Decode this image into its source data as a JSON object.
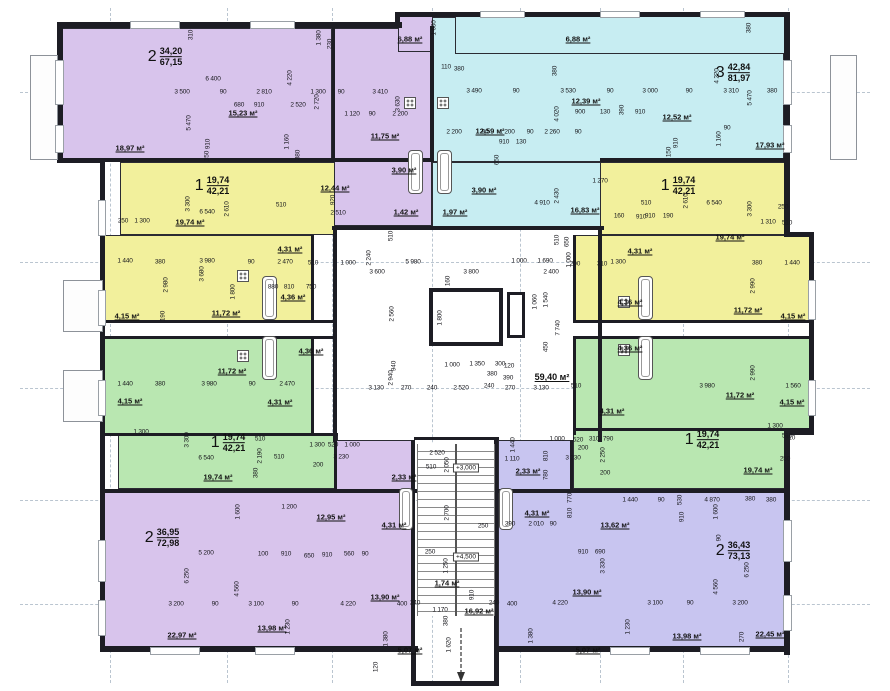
{
  "sheet": {
    "width": 890,
    "height": 691
  },
  "colors": {
    "purple": "#d8c4ec",
    "cyan": "#c7edf2",
    "yellow": "#f2f09c",
    "green": "#b9e7b1",
    "blue": "#c8c5f0",
    "wall": "#1d1d24",
    "text": "#17171c",
    "axis": "#b6c2cc"
  },
  "apartments": [
    {
      "id": "apt-2room-top-left",
      "color": "purple",
      "unit": {
        "num": "2",
        "area_living": "34,20",
        "area_total": "67,15"
      },
      "unit_pos": {
        "x": 165,
        "y": 57
      },
      "regions": [
        [
          57,
          28,
          275,
          132
        ],
        [
          332,
          28,
          100,
          198
        ],
        [
          398,
          12,
          57,
          40
        ]
      ]
    },
    {
      "id": "apt-3room-top-right",
      "color": "cyan",
      "unit": {
        "num": "3",
        "area_living": "42,84",
        "area_total": "81,97"
      },
      "unit_pos": {
        "x": 733,
        "y": 73
      },
      "regions": [
        [
          432,
          17,
          352,
          145
        ],
        [
          432,
          162,
          172,
          66
        ],
        [
          455,
          12,
          333,
          42
        ]
      ]
    },
    {
      "id": "apt-1room-left-upper",
      "color": "yellow",
      "unit": {
        "num": "1",
        "area_living": "19,74",
        "area_total": "42,21"
      },
      "unit_pos": {
        "x": 212,
        "y": 186
      },
      "regions": [
        [
          120,
          162,
          215,
          73
        ],
        [
          103,
          235,
          210,
          87
        ]
      ]
    },
    {
      "id": "apt-1room-right-upper",
      "color": "yellow",
      "unit": {
        "num": "1",
        "area_living": "19,74",
        "area_total": "42,21"
      },
      "unit_pos": {
        "x": 678,
        "y": 186
      },
      "regions": [
        [
          600,
          162,
          188,
          73
        ],
        [
          575,
          235,
          238,
          87
        ]
      ]
    },
    {
      "id": "apt-1room-left-lower",
      "color": "green",
      "unit": {
        "num": "1",
        "area_living": "19,74",
        "area_total": "42,21"
      },
      "unit_pos": {
        "x": 228,
        "y": 443
      },
      "regions": [
        [
          103,
          338,
          210,
          97
        ],
        [
          118,
          435,
          220,
          54
        ]
      ]
    },
    {
      "id": "apt-1room-right-lower",
      "color": "green",
      "unit": {
        "num": "1",
        "area_living": "19,74",
        "area_total": "42,21"
      },
      "unit_pos": {
        "x": 702,
        "y": 440
      },
      "regions": [
        [
          575,
          338,
          238,
          92
        ],
        [
          573,
          430,
          217,
          59
        ]
      ]
    },
    {
      "id": "apt-2room-bottom-left",
      "color": "purple",
      "unit": {
        "num": "2",
        "area_living": "36,95",
        "area_total": "72,98"
      },
      "unit_pos": {
        "x": 162,
        "y": 538
      },
      "regions": [
        [
          100,
          492,
          314,
          156
        ],
        [
          336,
          440,
          78,
          52
        ]
      ]
    },
    {
      "id": "apt-2room-bottom-right",
      "color": "blue",
      "unit": {
        "num": "2",
        "area_living": "36,43",
        "area_total": "73,13"
      },
      "unit_pos": {
        "x": 733,
        "y": 551
      },
      "regions": [
        [
          498,
          492,
          290,
          156
        ],
        [
          498,
          440,
          75,
          52
        ]
      ]
    }
  ],
  "core": {
    "levels": [
      [
        "+3,000",
        466,
        468
      ],
      [
        "+4,500",
        466,
        557
      ]
    ]
  },
  "room_labels": [
    [
      "18,97 м²",
      130,
      148
    ],
    [
      "15,23 м²",
      243,
      113
    ],
    [
      "11,75 м²",
      385,
      136
    ],
    [
      "3,90 м²",
      404,
      170
    ],
    [
      "12,44 м²",
      335,
      188
    ],
    [
      "1,42 м²",
      406,
      212
    ],
    [
      "6,88 м²",
      410,
      39
    ],
    [
      "6,88 м²",
      578,
      39
    ],
    [
      "12,59 м²",
      490,
      131
    ],
    [
      "12,39 м²",
      586,
      101
    ],
    [
      "3,90 м²",
      484,
      190
    ],
    [
      "1,97 м²",
      455,
      212
    ],
    [
      "16,83 м²",
      585,
      210
    ],
    [
      "12,52 м²",
      677,
      117
    ],
    [
      "17,93 м²",
      770,
      145
    ],
    [
      "19,74 м²",
      190,
      222
    ],
    [
      "4,31 м²",
      290,
      249
    ],
    [
      "4,36 м²",
      293,
      297
    ],
    [
      "11,72 м²",
      226,
      313
    ],
    [
      "4,15 м²",
      127,
      316
    ],
    [
      "11,72 м²",
      232,
      371
    ],
    [
      "4,36 м²",
      311,
      351
    ],
    [
      "4,31 м²",
      280,
      402
    ],
    [
      "4,15 м²",
      130,
      401
    ],
    [
      "19,74 м²",
      218,
      477
    ],
    [
      "19,74 м²",
      730,
      237
    ],
    [
      "4,31 м²",
      640,
      251
    ],
    [
      "4,36 м²",
      630,
      302
    ],
    [
      "11,72 м²",
      748,
      310
    ],
    [
      "4,15 м²",
      793,
      316
    ],
    [
      "4,36 м²",
      630,
      348
    ],
    [
      "11,72 м²",
      740,
      395
    ],
    [
      "4,31 м²",
      612,
      411
    ],
    [
      "4,15 м²",
      792,
      402
    ],
    [
      "19,74 м²",
      758,
      470
    ],
    [
      "2,33 м²",
      404,
      477
    ],
    [
      "4,31 м²",
      394,
      525
    ],
    [
      "12,95 м²",
      331,
      517
    ],
    [
      "13,90 м²",
      385,
      597
    ],
    [
      "22,97 м²",
      182,
      635
    ],
    [
      "13,98 м²",
      272,
      628
    ],
    [
      "5,07 м²",
      410,
      650
    ],
    [
      "2,33 м²",
      528,
      471
    ],
    [
      "4,31 м²",
      537,
      513
    ],
    [
      "13,62 м²",
      615,
      525
    ],
    [
      "13,90 м²",
      587,
      592
    ],
    [
      "22,45 м²",
      770,
      634
    ],
    [
      "13,98 м²",
      687,
      636
    ],
    [
      "5,07 м²",
      588,
      650
    ],
    [
      "59,40 м²",
      552,
      377,
      1
    ],
    [
      "1,74 м²",
      447,
      583
    ],
    [
      "16,92 м²",
      479,
      611
    ]
  ],
  "dim_labels": [
    [
      "310",
      191,
      35,
      1
    ],
    [
      "1 380",
      319,
      38,
      1
    ],
    [
      "230",
      330,
      44,
      1
    ],
    [
      "1 630",
      434,
      28,
      1
    ],
    [
      "380",
      749,
      28,
      1
    ],
    [
      "6 400",
      213,
      79
    ],
    [
      "4 220",
      290,
      78,
      1
    ],
    [
      "4 220",
      717,
      76,
      1
    ],
    [
      "3 500",
      182,
      92
    ],
    [
      "90",
      223,
      92
    ],
    [
      "2 810",
      264,
      92
    ],
    [
      "1 300",
      318,
      92
    ],
    [
      "90",
      341,
      92
    ],
    [
      "3 410",
      380,
      92
    ],
    [
      "110",
      446,
      67
    ],
    [
      "380",
      459,
      69
    ],
    [
      "3 490",
      474,
      91
    ],
    [
      "90",
      516,
      91
    ],
    [
      "3 530",
      568,
      91
    ],
    [
      "90",
      610,
      91
    ],
    [
      "3 000",
      650,
      91
    ],
    [
      "90",
      689,
      91
    ],
    [
      "3 310",
      731,
      91
    ],
    [
      "380",
      772,
      91
    ],
    [
      "680",
      239,
      105
    ],
    [
      "910",
      259,
      105
    ],
    [
      "2 520",
      298,
      105
    ],
    [
      "5 470",
      189,
      123,
      1
    ],
    [
      "5 470",
      750,
      98,
      1
    ],
    [
      "380",
      555,
      71,
      1
    ],
    [
      "4 020",
      557,
      114,
      1
    ],
    [
      "900",
      580,
      112
    ],
    [
      "130",
      605,
      112
    ],
    [
      "390",
      622,
      110,
      1
    ],
    [
      "910",
      640,
      112
    ],
    [
      "1 120",
      352,
      114
    ],
    [
      "90",
      372,
      114
    ],
    [
      "2 200",
      400,
      114
    ],
    [
      "2 720",
      317,
      102,
      1
    ],
    [
      "3 630",
      398,
      104,
      1
    ],
    [
      "1 160",
      287,
      142,
      1
    ],
    [
      "380",
      298,
      155,
      1
    ],
    [
      "910",
      208,
      144,
      1
    ],
    [
      "150",
      207,
      156,
      1
    ],
    [
      "1 160",
      719,
      139,
      1
    ],
    [
      "90",
      727,
      128
    ],
    [
      "910",
      676,
      143,
      1
    ],
    [
      "150",
      669,
      152,
      1
    ],
    [
      "2 200",
      454,
      132
    ],
    [
      "90",
      485,
      132
    ],
    [
      "1 200",
      507,
      132
    ],
    [
      "90",
      530,
      132
    ],
    [
      "2 260",
      552,
      132
    ],
    [
      "90",
      578,
      132
    ],
    [
      "910",
      504,
      142
    ],
    [
      "130",
      521,
      142
    ],
    [
      "650",
      497,
      160,
      1
    ],
    [
      "2 430",
      557,
      196,
      1
    ],
    [
      "4 910",
      542,
      203
    ],
    [
      "1 270",
      600,
      181
    ],
    [
      "160",
      619,
      216
    ],
    [
      "910",
      641,
      217
    ],
    [
      "2 510",
      338,
      213
    ],
    [
      "920",
      333,
      200,
      1
    ],
    [
      "250",
      123,
      221
    ],
    [
      "1 300",
      142,
      221
    ],
    [
      "6 540",
      207,
      212
    ],
    [
      "2 610",
      227,
      209,
      1
    ],
    [
      "3 300",
      188,
      204,
      1
    ],
    [
      "510",
      281,
      205
    ],
    [
      "510",
      646,
      203
    ],
    [
      "910",
      650,
      216
    ],
    [
      "190",
      668,
      216
    ],
    [
      "6 540",
      714,
      203
    ],
    [
      "2 610",
      686,
      201,
      1
    ],
    [
      "3 300",
      750,
      209,
      1
    ],
    [
      "1 310",
      768,
      222
    ],
    [
      "510",
      787,
      223
    ],
    [
      "250",
      783,
      207
    ],
    [
      "1 440",
      125,
      261
    ],
    [
      "380",
      160,
      262
    ],
    [
      "3 980",
      207,
      261
    ],
    [
      "90",
      251,
      262
    ],
    [
      "2 470",
      285,
      262
    ],
    [
      "510",
      313,
      263
    ],
    [
      "1 000",
      348,
      263
    ],
    [
      "2 980",
      166,
      285,
      1
    ],
    [
      "3 680",
      202,
      274,
      1
    ],
    [
      "880",
      273,
      287
    ],
    [
      "810",
      289,
      287
    ],
    [
      "750",
      311,
      287
    ],
    [
      "190",
      163,
      316,
      1
    ],
    [
      "1 800",
      233,
      292,
      1
    ],
    [
      "1 440",
      125,
      384
    ],
    [
      "380",
      160,
      384
    ],
    [
      "3 980",
      209,
      384
    ],
    [
      "90",
      252,
      384
    ],
    [
      "2 470",
      287,
      384
    ],
    [
      "1 300",
      141,
      432
    ],
    [
      "1 440",
      792,
      263
    ],
    [
      "380",
      757,
      263
    ],
    [
      "2 990",
      753,
      286,
      1
    ],
    [
      "1 300",
      618,
      262
    ],
    [
      "1 560",
      793,
      386
    ],
    [
      "3 980",
      707,
      386
    ],
    [
      "2 990",
      753,
      373,
      1
    ],
    [
      "1 300",
      775,
      426
    ],
    [
      "510",
      790,
      438
    ],
    [
      "510",
      391,
      236,
      1
    ],
    [
      "2 240",
      369,
      258,
      1
    ],
    [
      "5 980",
      413,
      262
    ],
    [
      "1 000",
      519,
      261
    ],
    [
      "1 690",
      545,
      261
    ],
    [
      "3 600",
      377,
      272
    ],
    [
      "3 800",
      471,
      272
    ],
    [
      "2 400",
      551,
      272
    ],
    [
      "650",
      567,
      242,
      1
    ],
    [
      "510",
      557,
      240,
      1
    ],
    [
      "1 000",
      569,
      260,
      1
    ],
    [
      "200",
      575,
      264
    ],
    [
      "310",
      602,
      264
    ],
    [
      "160",
      448,
      281,
      1
    ],
    [
      "2 560",
      392,
      314,
      1
    ],
    [
      "1 800",
      440,
      318,
      1
    ],
    [
      "2 940",
      391,
      378,
      1
    ],
    [
      "7 740",
      558,
      328,
      1
    ],
    [
      "1 540",
      546,
      300,
      1
    ],
    [
      "1 060",
      535,
      302,
      1
    ],
    [
      "450",
      546,
      347,
      1
    ],
    [
      "940",
      394,
      366,
      1
    ],
    [
      "1 000",
      452,
      365
    ],
    [
      "1 350",
      477,
      364
    ],
    [
      "300",
      500,
      364
    ],
    [
      "380",
      492,
      374
    ],
    [
      "120",
      509,
      366
    ],
    [
      "390",
      508,
      378
    ],
    [
      "3 130",
      376,
      388
    ],
    [
      "270",
      406,
      388
    ],
    [
      "240",
      432,
      388
    ],
    [
      "2 520",
      461,
      388
    ],
    [
      "240",
      489,
      386
    ],
    [
      "270",
      510,
      388
    ],
    [
      "3 130",
      541,
      388
    ],
    [
      "510",
      576,
      386
    ],
    [
      "1 300",
      317,
      445
    ],
    [
      "520",
      333,
      445
    ],
    [
      "1 000",
      352,
      445
    ],
    [
      "3 230",
      341,
      457
    ],
    [
      "200",
      318,
      465
    ],
    [
      "3 300",
      187,
      440,
      1
    ],
    [
      "2 190",
      260,
      456,
      1
    ],
    [
      "510",
      260,
      439
    ],
    [
      "6 540",
      206,
      458
    ],
    [
      "510",
      279,
      457
    ],
    [
      "380",
      256,
      473,
      1
    ],
    [
      "1 600",
      238,
      512,
      1
    ],
    [
      "5 200",
      206,
      553
    ],
    [
      "100",
      263,
      554
    ],
    [
      "910",
      286,
      554
    ],
    [
      "6 250",
      187,
      576,
      1
    ],
    [
      "4 560",
      237,
      589,
      1
    ],
    [
      "3 200",
      176,
      604
    ],
    [
      "90",
      215,
      604
    ],
    [
      "3 100",
      256,
      604
    ],
    [
      "90",
      295,
      604
    ],
    [
      "1 230",
      288,
      627,
      1
    ],
    [
      "1 200",
      289,
      507
    ],
    [
      "650",
      309,
      556
    ],
    [
      "910",
      327,
      555
    ],
    [
      "560",
      349,
      554
    ],
    [
      "90",
      365,
      554
    ],
    [
      "2 520",
      437,
      453
    ],
    [
      "510",
      431,
      467
    ],
    [
      "2 050",
      447,
      465,
      1
    ],
    [
      "2 700",
      447,
      513,
      1
    ],
    [
      "250",
      483,
      526
    ],
    [
      "1 250",
      446,
      566,
      1
    ],
    [
      "250",
      430,
      552
    ],
    [
      "910",
      472,
      595,
      1
    ],
    [
      "240",
      415,
      603
    ],
    [
      "400",
      402,
      604
    ],
    [
      "240",
      494,
      603
    ],
    [
      "400",
      512,
      604
    ],
    [
      "4 220",
      348,
      604
    ],
    [
      "4 220",
      560,
      603
    ],
    [
      "1 170",
      440,
      610
    ],
    [
      "380",
      446,
      621,
      1
    ],
    [
      "1 620",
      449,
      645,
      1
    ],
    [
      "120",
      376,
      667,
      1
    ],
    [
      "1 380",
      386,
      639,
      1
    ],
    [
      "1 380",
      531,
      636,
      1
    ],
    [
      "1 110",
      512,
      459
    ],
    [
      "1 440",
      513,
      445,
      1
    ],
    [
      "1 000",
      557,
      439
    ],
    [
      "520",
      578,
      440
    ],
    [
      "310",
      594,
      439
    ],
    [
      "790",
      608,
      439
    ],
    [
      "200",
      583,
      448
    ],
    [
      "3 230",
      573,
      458
    ],
    [
      "2 250",
      603,
      455,
      1
    ],
    [
      "200",
      605,
      473
    ],
    [
      "810",
      546,
      456,
      1
    ],
    [
      "780",
      546,
      475,
      1
    ],
    [
      "770",
      570,
      498,
      1
    ],
    [
      "810",
      570,
      513,
      1
    ],
    [
      "390",
      510,
      524
    ],
    [
      "2 010",
      536,
      524
    ],
    [
      "90",
      553,
      524
    ],
    [
      "910",
      583,
      552
    ],
    [
      "690",
      600,
      552
    ],
    [
      "3 330",
      603,
      566,
      1
    ],
    [
      "1 440",
      630,
      500
    ],
    [
      "90",
      661,
      500
    ],
    [
      "530",
      680,
      500,
      1
    ],
    [
      "4 870",
      712,
      500
    ],
    [
      "380",
      750,
      499
    ],
    [
      "380",
      771,
      500
    ],
    [
      "1 600",
      716,
      512,
      1
    ],
    [
      "910",
      682,
      517,
      1
    ],
    [
      "90",
      719,
      538,
      1
    ],
    [
      "6 250",
      747,
      570,
      1
    ],
    [
      "4 560",
      716,
      587,
      1
    ],
    [
      "3 100",
      655,
      603
    ],
    [
      "90",
      690,
      603
    ],
    [
      "3 200",
      740,
      603
    ],
    [
      "510",
      787,
      436
    ],
    [
      "250",
      785,
      459
    ],
    [
      "1 230",
      628,
      627,
      1
    ],
    [
      "270",
      742,
      637,
      1
    ]
  ]
}
